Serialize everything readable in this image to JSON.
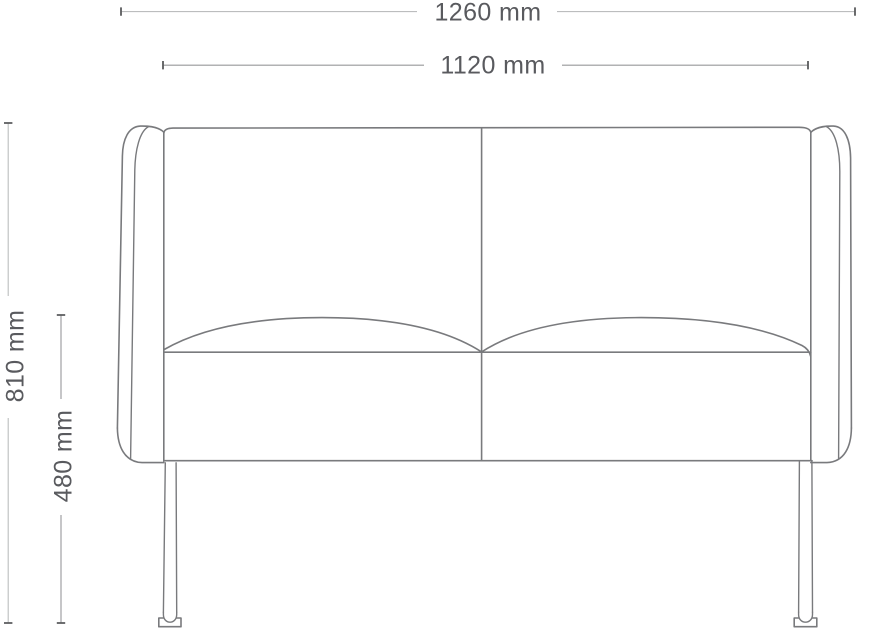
{
  "drawing": {
    "subject": "two-seat-sofa-front-elevation-dimension-diagram",
    "units": "mm",
    "dims": {
      "overall_width": {
        "value": 1260,
        "unit": "mm",
        "label": "1260 mm"
      },
      "inner_width": {
        "value": 1120,
        "unit": "mm",
        "label": "1120 mm"
      },
      "overall_height": {
        "value": 810,
        "unit": "mm",
        "label": "810 mm"
      },
      "seat_height": {
        "value": 480,
        "unit": "mm",
        "label": "480 mm"
      }
    },
    "style": {
      "bg": "#ffffff",
      "outline_color": "#797a7d",
      "dim_line_light": "#bcbdbe",
      "dim_line": "#97989a",
      "tick_color": "#5a5b5d",
      "label_color": "#595a5e"
    }
  }
}
